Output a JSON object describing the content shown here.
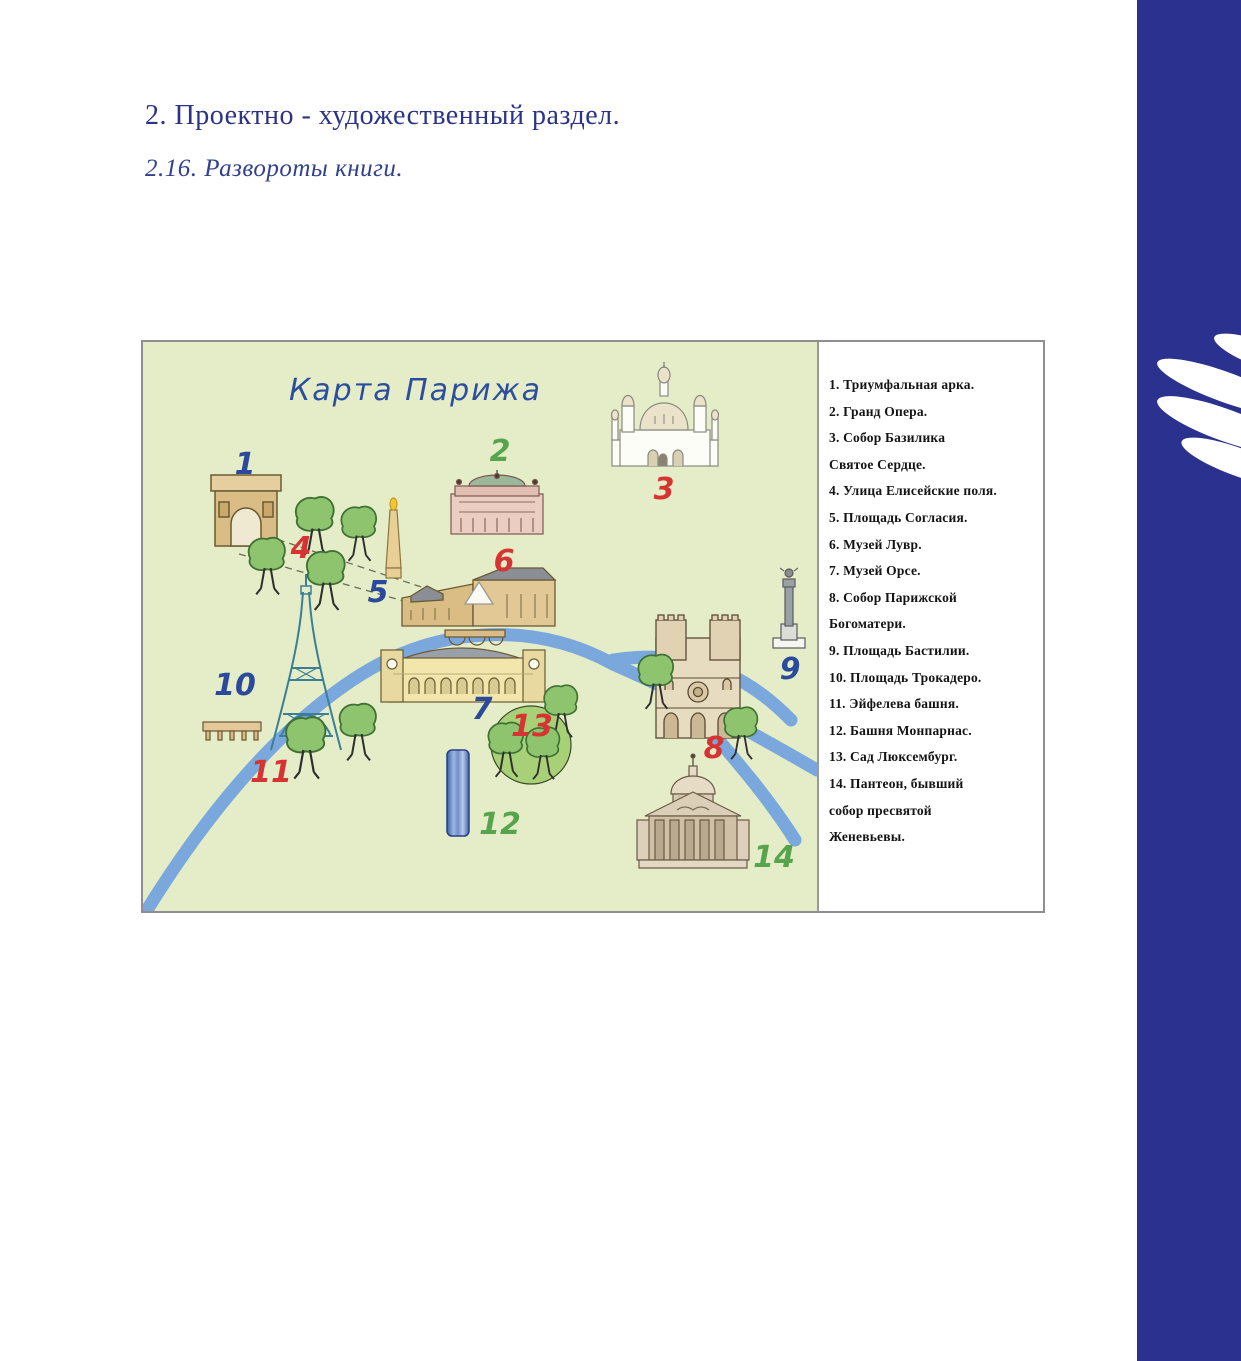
{
  "headings": {
    "section": "2. Проектно - художественный раздел.",
    "subsection": "2.16. Развороты книги."
  },
  "map": {
    "title": "Карта Парижа",
    "markers": [
      {
        "label": "1",
        "color": "blue"
      },
      {
        "label": "2",
        "color": "green"
      },
      {
        "label": "3",
        "color": "red"
      },
      {
        "label": "4",
        "color": "red"
      },
      {
        "label": "5",
        "color": "blue"
      },
      {
        "label": "6",
        "color": "red"
      },
      {
        "label": "7",
        "color": "blue"
      },
      {
        "label": "8",
        "color": "red"
      },
      {
        "label": "9",
        "color": "blue"
      },
      {
        "label": "10",
        "color": "blue"
      },
      {
        "label": "11",
        "color": "red"
      },
      {
        "label": "12",
        "color": "green"
      },
      {
        "label": "13",
        "color": "red"
      },
      {
        "label": "14",
        "color": "green"
      }
    ]
  },
  "legend": {
    "lines": [
      "1. Триумфальная арка.",
      "2. Гранд Опера.",
      "3. Собор Базилика",
      "Святое Сердце.",
      "4. Улица Елисейские поля.",
      "5. Площадь Согласия.",
      "6. Музей Лувр.",
      "7. Музей Орсе.",
      "8. Собор Парижской",
      "Богоматери.",
      "9. Площадь Бастилии.",
      "10. Площадь Трокадеро.",
      "11. Эйфелева башня.",
      "12. Башня Монпарнас.",
      "13. Сад Люксембург.",
      "14. Пантеон, бывший",
      "собор пресвятой",
      "Женевьевы."
    ]
  },
  "colors": {
    "heading": "#2c3487",
    "map_background": "#e5edc8",
    "river": "#7aa8dc",
    "marker_blue": "#2b4a9b",
    "marker_red": "#d63333",
    "marker_green": "#56a44c",
    "side_band": "#2b318e",
    "map_title": "#2d4e9e"
  }
}
